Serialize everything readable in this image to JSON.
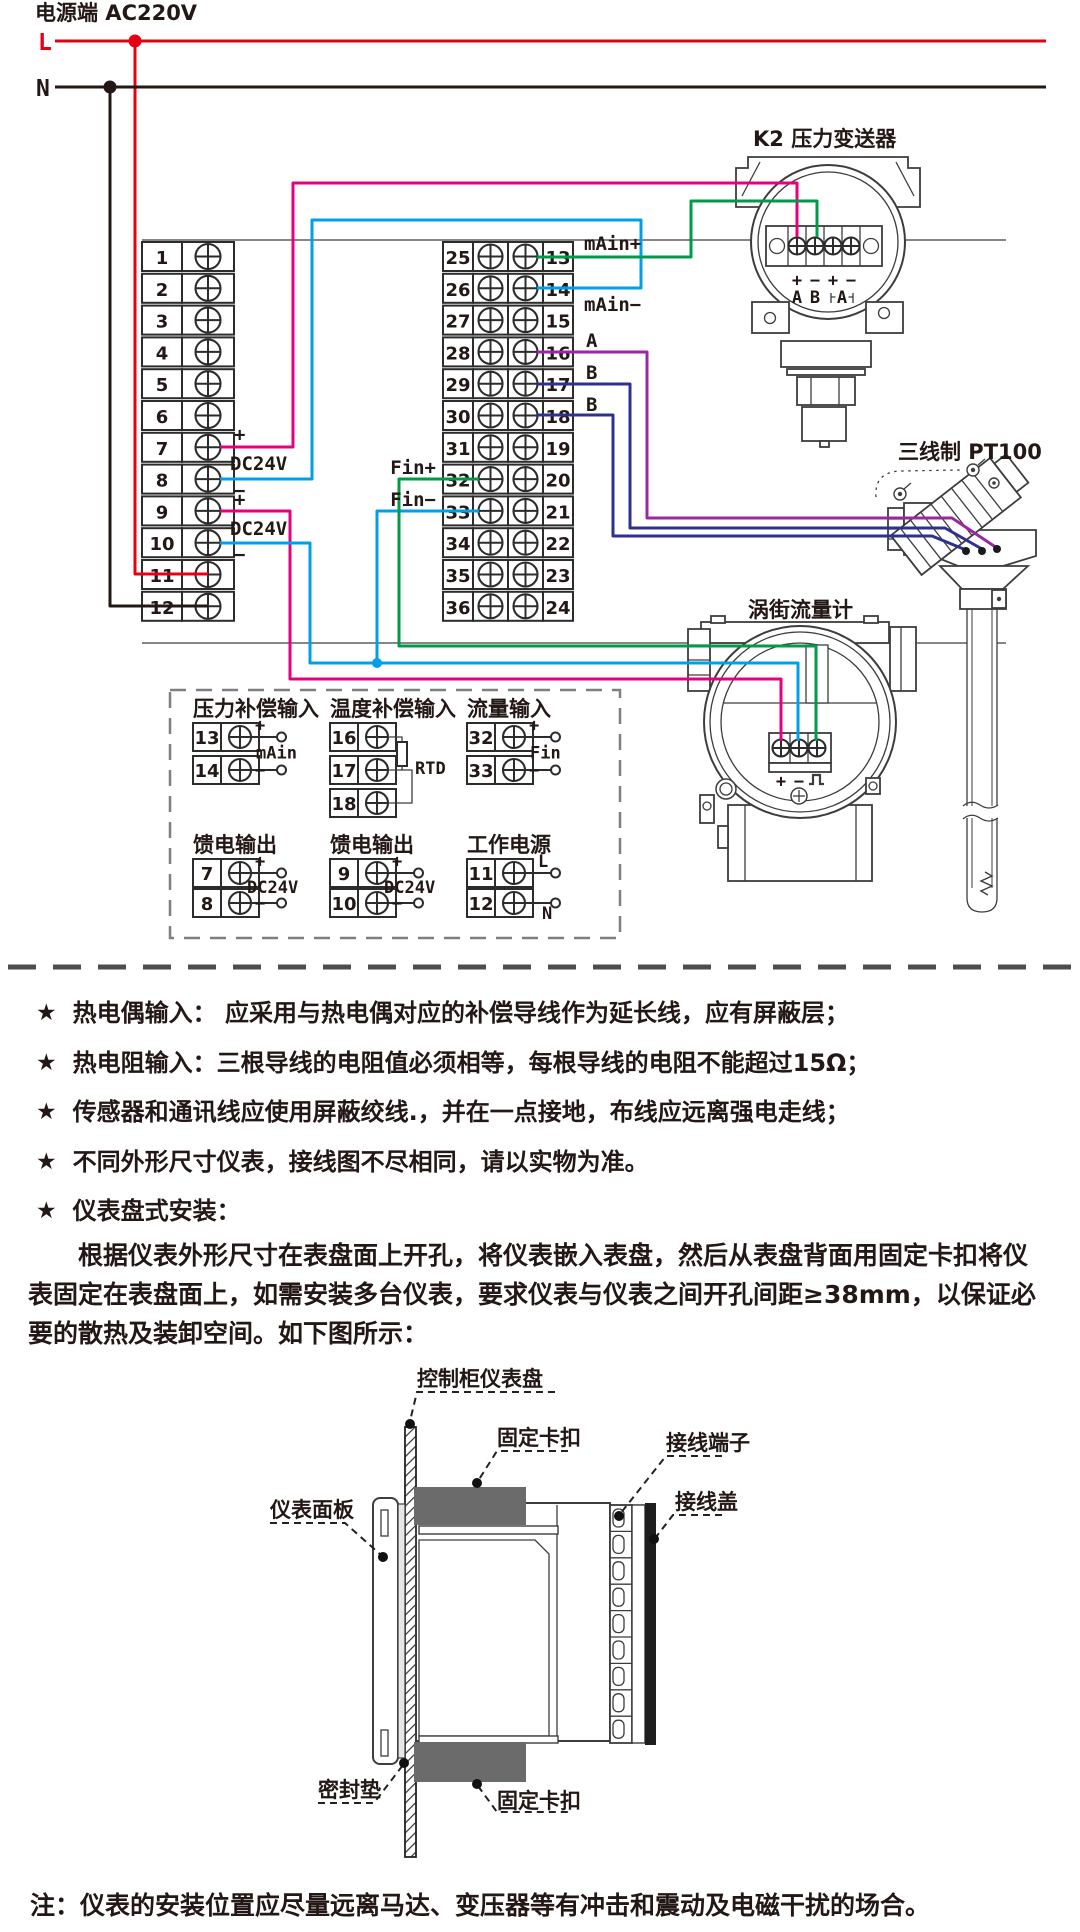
{
  "star": "★",
  "colors": {
    "red": "#e60012",
    "magenta": "#e4007f",
    "blue": "#00a0e9",
    "green": "#009b48",
    "purple": "#9c27a0",
    "navy": "#2e3192",
    "line": "#231815",
    "clip_gray": "#6b6b6b"
  },
  "power": {
    "title": "电源端 AC220V",
    "l": "L",
    "n": "N"
  },
  "terminal_blocks": {
    "left": [
      "1",
      "2",
      "3",
      "4",
      "5",
      "6",
      "7",
      "8",
      "9",
      "10",
      "11",
      "12"
    ],
    "mid": [
      "25",
      "26",
      "27",
      "28",
      "29",
      "30",
      "31",
      "32",
      "33",
      "34",
      "35",
      "36"
    ],
    "right": [
      "13",
      "14",
      "15",
      "16",
      "17",
      "18",
      "19",
      "20",
      "21",
      "22",
      "23",
      "24"
    ]
  },
  "wire_labels": {
    "main_plus": "mAin+",
    "main_minus": "mAin−",
    "a": "A",
    "b": "B",
    "fin_plus": "Fin+",
    "fin_minus": "Fin−",
    "plus": "+",
    "minus": "−",
    "dc24v": "DC24V"
  },
  "transmitter": {
    "title": "K2 压力变送器",
    "marks": [
      "+",
      "−",
      "+",
      "−"
    ],
    "names": [
      "A",
      "B"
    ],
    "bracket_name": "A"
  },
  "pt100": {
    "title": "三线制 PT100"
  },
  "vortex": {
    "title": "涡街流量计",
    "plus": "+",
    "minus": "−",
    "pulse_symbol": "⎍"
  },
  "comp_box": {
    "groups": [
      {
        "title": "压力补偿输入",
        "rows": [
          {
            "no": "13",
            "sign": "+"
          },
          {
            "no": "14",
            "sign": "−"
          }
        ],
        "mid_label": "mAin"
      },
      {
        "title": "温度补偿输入",
        "rows": [
          {
            "no": "16",
            "sign": ""
          },
          {
            "no": "17",
            "sign": ""
          },
          {
            "no": "18",
            "sign": ""
          }
        ],
        "mid_label": "RTD"
      },
      {
        "title": "流量输入",
        "rows": [
          {
            "no": "32",
            "sign": "+"
          },
          {
            "no": "33",
            "sign": "−"
          }
        ],
        "mid_label": "Fin"
      },
      {
        "title": "馈电输出",
        "rows": [
          {
            "no": "7",
            "sign": "+"
          },
          {
            "no": "8",
            "sign": "−"
          }
        ],
        "mid_label": "DC24V"
      },
      {
        "title": "馈电输出",
        "rows": [
          {
            "no": "9",
            "sign": "+"
          },
          {
            "no": "10",
            "sign": "−"
          }
        ],
        "mid_label": "DC24V"
      },
      {
        "title": "工作电源",
        "rows": [
          {
            "no": "11",
            "sign": "L"
          },
          {
            "no": "12",
            "sign": "N"
          }
        ],
        "mid_label": ""
      }
    ]
  },
  "notes": [
    "热电偶输入： 应采用与热电偶对应的补偿导线作为延长线，应有屏蔽层；",
    "热电阻输入：三根导线的电阻值必须相等，每根导线的电阻不能超过15Ω；",
    "传感器和通讯线应使用屏蔽绞线.，并在一点接地，布线应远离强电走线；",
    "不同外形尺寸仪表，接线图不尽相同，请以实物为准。",
    "仪表盘式安装："
  ],
  "install": {
    "paragraph": "根据仪表外形尺寸在表盘面上开孔，将仪表嵌入表盘，然后从表盘背面用固定卡扣将仪表固定在表盘面上，如需安装多台仪表，要求仪表与仪表之间开孔间距≥38mm，以保证必要的散热及装卸空间。如下图所示：",
    "labels": {
      "panel": "控制柜仪表盘",
      "clip_top": "固定卡扣",
      "terminals": "接线端子",
      "cover": "接线盖",
      "front_panel": "仪表面板",
      "gasket": "密封垫",
      "clip_bottom": "固定卡扣"
    }
  },
  "footnote": "注：仪表的安装位置应尽量远离马达、变压器等有冲击和震动及电磁干扰的场合。"
}
